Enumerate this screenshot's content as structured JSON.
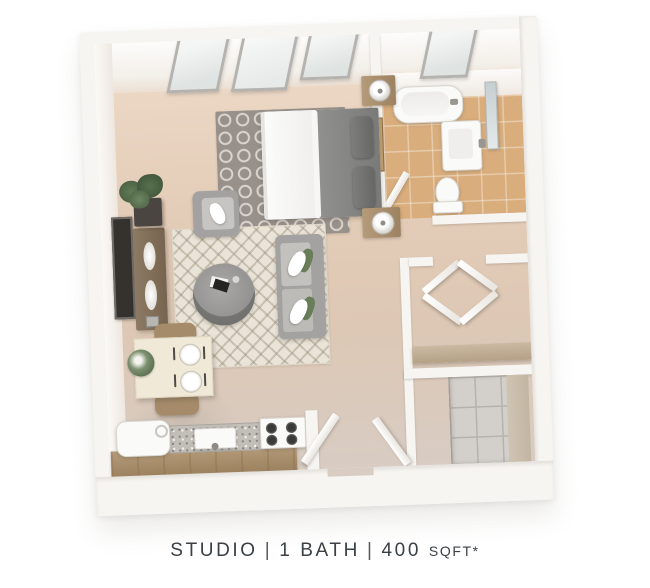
{
  "caption": {
    "plan_type": "STUDIO",
    "separator": "|",
    "baths": "1 BATH",
    "area": "400",
    "area_unit": "SQFT*"
  },
  "colors": {
    "page-bg": "#ffffff",
    "wall": "#f7f5f1",
    "floor-main-light": "#eedbc9",
    "floor-main": "#e3ccb7",
    "floor-lower": "#d8ccc3",
    "tile": "#d9ad7c",
    "rug-trellis": "#98918a",
    "rug-trellis-line": "#d9d5d0",
    "rug-chevron": "#eae4d8",
    "upholstery": "#a3a2a0",
    "comforter": "#80807e",
    "wood-dark": "#83705c",
    "wood-light": "#b59b79",
    "wood-shelf": "#cbb9a2",
    "fixture-white": "#fafaf8",
    "granite": "#c2beb8",
    "accent-green": "#687d58",
    "mirror": "#c5ced1",
    "caption-text": "#3b4045"
  }
}
